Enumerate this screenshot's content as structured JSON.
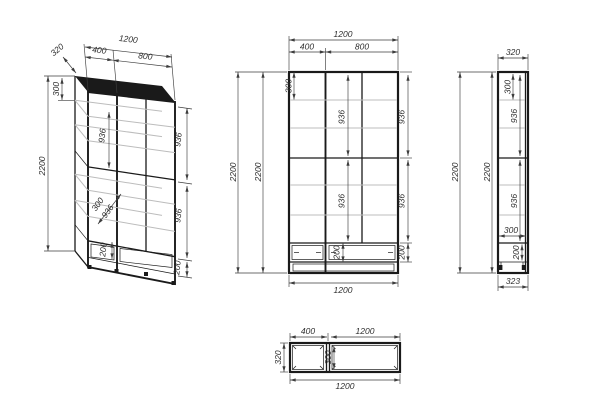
{
  "colors": {
    "background": "#ffffff",
    "line": "#1a1a1a",
    "shelf": "#bcbcbc",
    "dim": "#3d3d3d",
    "text": "#2e2e2e"
  },
  "views": {
    "iso": {
      "dims": {
        "depth": "320",
        "width_left": "400",
        "width_total": "1200",
        "width_right": "800",
        "top_section": "300",
        "height_total": "2200",
        "mid_upper": "936",
        "mid_shelf": "300",
        "mid_lower": "936",
        "mid_drawer": "200",
        "right_upper": "936",
        "right_lower": "936",
        "right_drawer": "200"
      }
    },
    "front": {
      "dims": {
        "width_total": "1200",
        "width_left": "400",
        "width_right": "800",
        "height_outer": "2200",
        "height_inner": "2200",
        "top_section": "300",
        "mid_upper": "936",
        "mid_lower": "936",
        "right_upper": "936",
        "right_lower": "936",
        "mid_drawer": "200",
        "right_drawer": "200",
        "width_bottom": "1200"
      }
    },
    "side": {
      "dims": {
        "depth_top": "320",
        "height_outer": "2200",
        "height_inner": "2200",
        "top_section": "300",
        "upper": "936",
        "lower": "936",
        "inner_depth": "300",
        "drawer": "200",
        "depth_bottom": "323"
      }
    },
    "top": {
      "dims": {
        "width_left": "400",
        "width_right": "1200",
        "depth": "320",
        "divider_depth": "300",
        "width_bottom": "1200"
      }
    }
  }
}
